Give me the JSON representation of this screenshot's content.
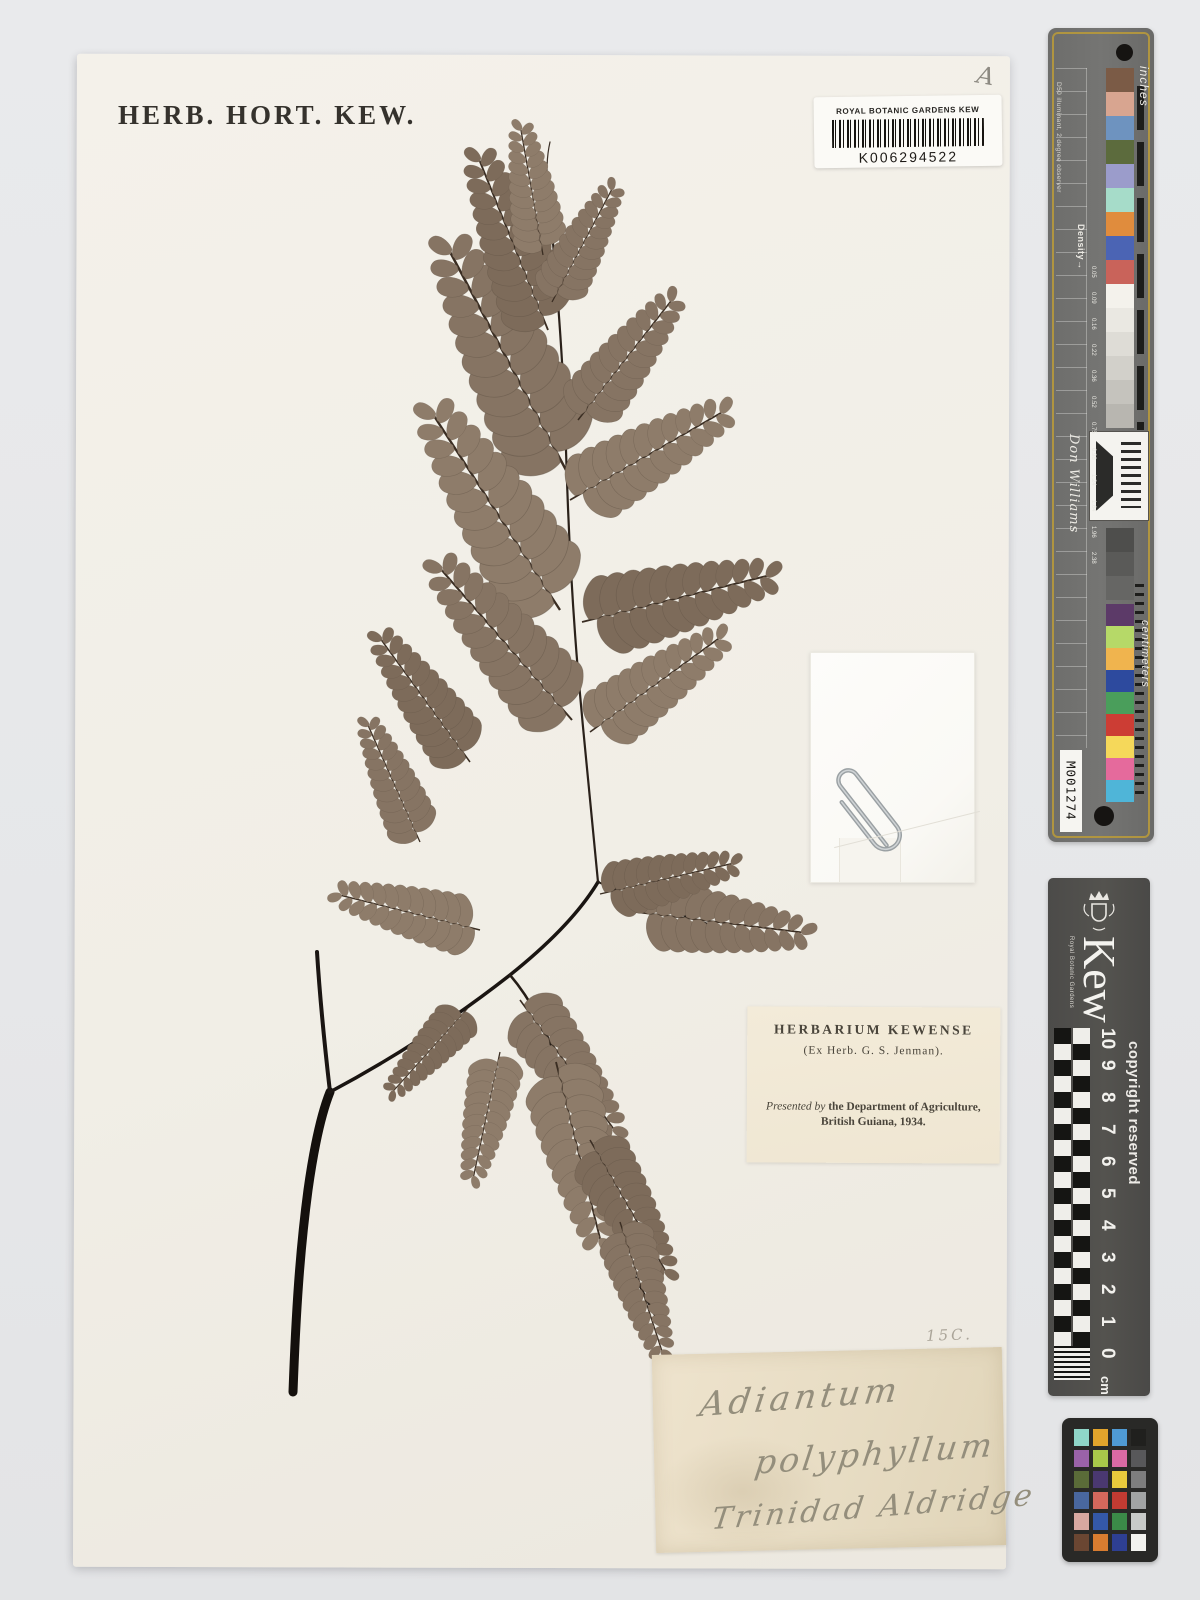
{
  "sheet": {
    "stamp": "HERB. HORT. KEW.",
    "corner_annotation": "A",
    "pencil_annotation": "15C."
  },
  "barcode_label": {
    "institution": "ROYAL BOTANIC GARDENS KEW",
    "number": "K006294522"
  },
  "herbarium_label": {
    "line1": "HERBARIUM  KEWENSE",
    "line2": "(Ex Herb. G. S. Jenman).",
    "presented_italic": "Presented by",
    "presented_rest": " the Department of Agriculture,",
    "line4": "British Guiana, 1934."
  },
  "determination_label": {
    "line1": "Adiantum",
    "line2": "polyphyllum",
    "line3": "Trinidad  Aldridge"
  },
  "calibration_strip": {
    "inches_label": "inches",
    "centimeters_label": "centimeters",
    "density_label": "Density",
    "density_arrow": "→",
    "illuminant_note": "D50 illuminant, 2 degree observer",
    "signature": "Don Williams",
    "id_label": "M001274",
    "density_values": [
      "0.05",
      "0.09",
      "0.16",
      "0.22",
      "0.36",
      "0.52",
      "0.75",
      "0.98",
      "1.24",
      "1.64",
      "1.96",
      "2.38"
    ],
    "top_patches": [
      "#7b5b46",
      "#d8a590",
      "#6e93bf",
      "#5c6b3d",
      "#9b9ccb",
      "#a6dcc9",
      "#e08c3d",
      "#4b64b4",
      "#c9635a",
      "#f4f2ec",
      "#eae8e2",
      "#dedcd6",
      "#d2d0ca",
      "#c5c3bd",
      "#b8b6b0"
    ],
    "dark_patches": [
      "#4e4e4c",
      "#5a5a58",
      "#666664"
    ],
    "bottom_patches": [
      "#5c3a68",
      "#b6d968",
      "#f0b44e",
      "#2d4a9e",
      "#4a9e5b",
      "#cc3d34",
      "#f5d85a",
      "#e56a9c",
      "#4fb5d8"
    ]
  },
  "kew_ruler": {
    "brand": "Kew",
    "brand_sub": "Royal Botanic Gardens",
    "copyright": "copyright reserved",
    "unit": "cm",
    "numbers": [
      "0",
      "1",
      "2",
      "3",
      "4",
      "5",
      "6",
      "7",
      "8",
      "9",
      "10"
    ]
  },
  "color_checker": {
    "rows": [
      [
        "#8fd6c8",
        "#e2a42c",
        "#4f9ad4",
        "#20201e"
      ],
      [
        "#9a62a8",
        "#a8c84a",
        "#da6aa4",
        "#58585a"
      ],
      [
        "#5a6b38",
        "#4a3870",
        "#e8c93c",
        "#7e7e7e"
      ],
      [
        "#49679e",
        "#d4685c",
        "#c23b32",
        "#a2a4a4"
      ],
      [
        "#d8a8a0",
        "#3458a8",
        "#3b8a48",
        "#c8cac8"
      ],
      [
        "#6a4632",
        "#d87c30",
        "#2e3f92",
        "#f2f2ee"
      ]
    ]
  }
}
